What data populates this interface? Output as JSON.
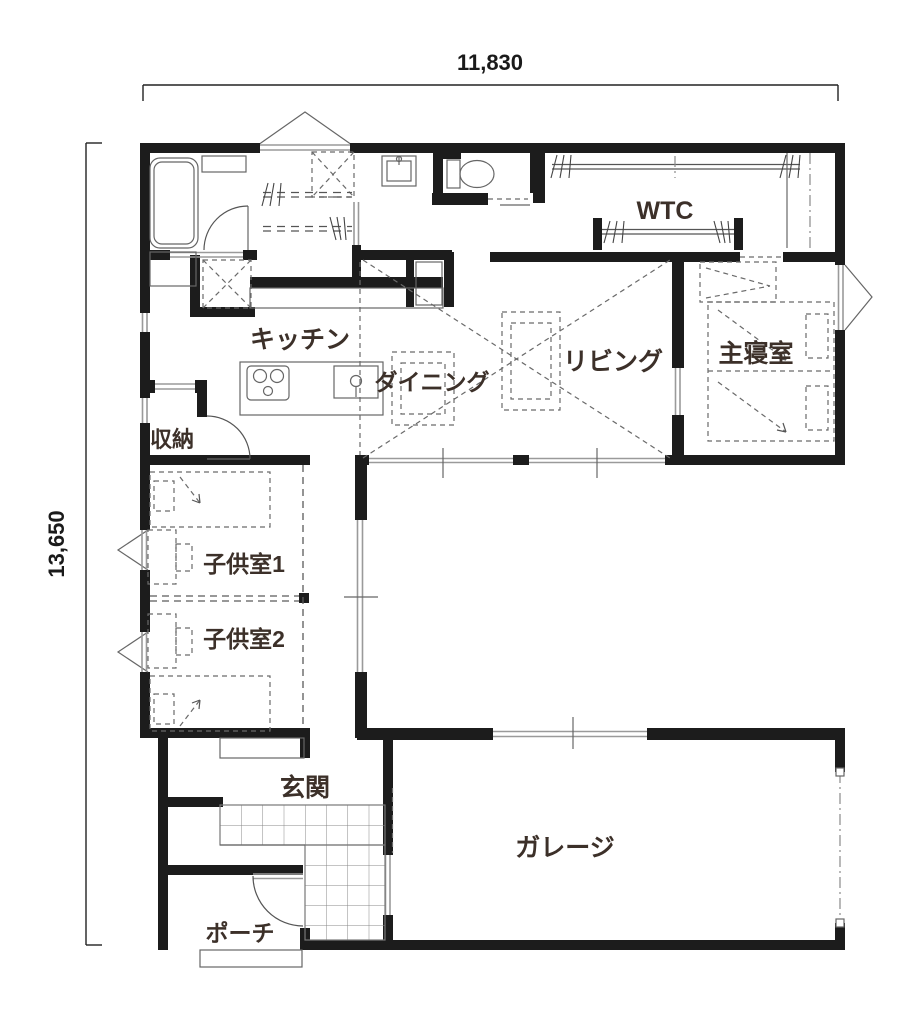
{
  "title": "floor-plan",
  "dimensions": {
    "width_label": "11,830",
    "height_label": "13,650"
  },
  "rooms": {
    "wtc": "WTC",
    "kitchen": "キッチン",
    "dining": "ダイニング",
    "living": "リビング",
    "master_bedroom": "主寝室",
    "storage": "収納",
    "kids_room_1": "子供室1",
    "kids_room_2": "子供室2",
    "entrance": "玄関",
    "garage": "ガレージ",
    "porch": "ポーチ"
  },
  "colors": {
    "wall": "#1c1c1c",
    "label_text": "#3c3029",
    "dimension_text": "#1a1a1a",
    "window_line": "#9a9a9a",
    "dashed_line": "#5a5a5a",
    "background": "#ffffff"
  }
}
